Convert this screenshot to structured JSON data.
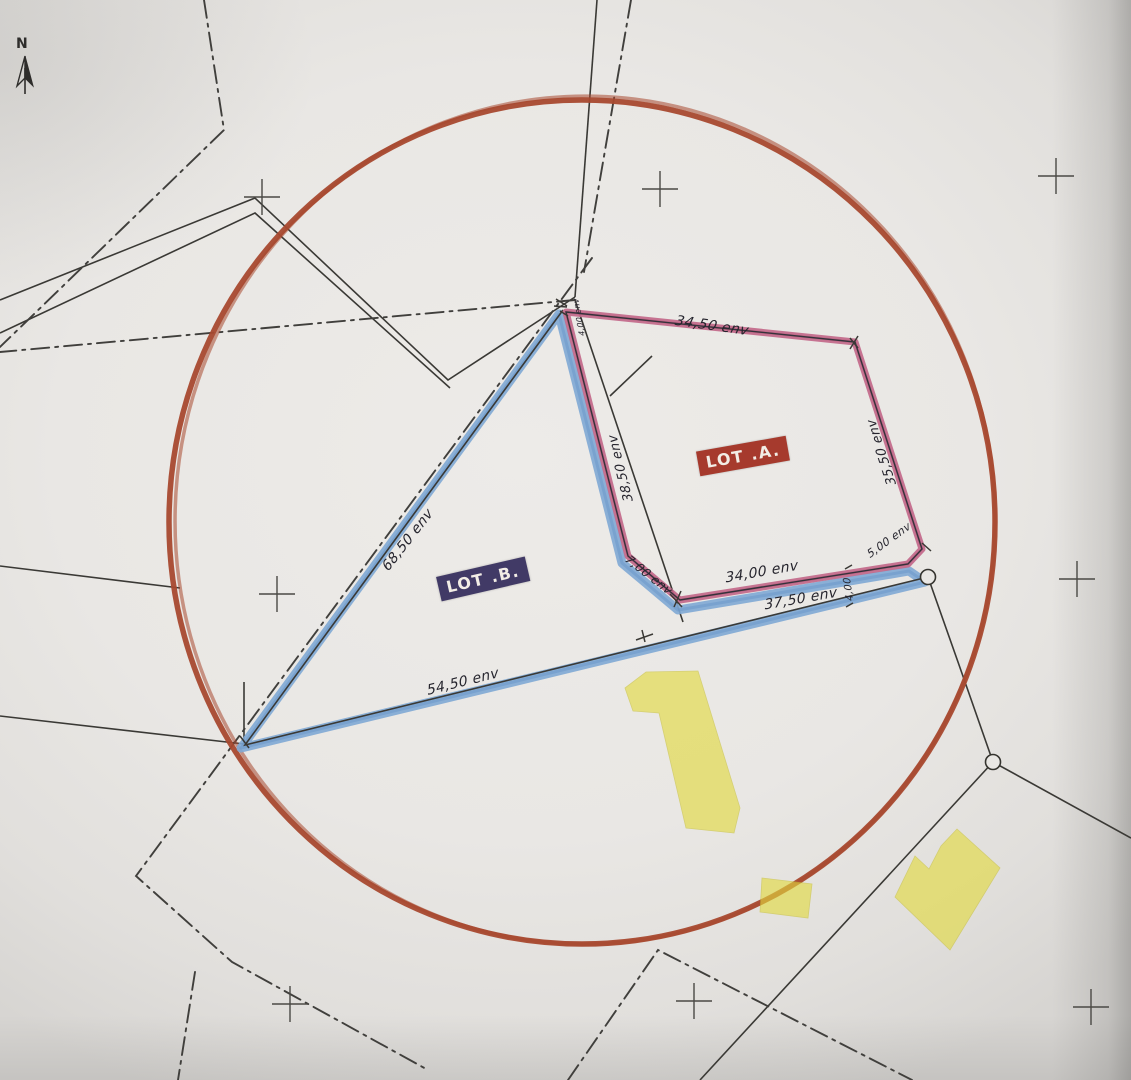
{
  "north_arrow": {
    "label": "N"
  },
  "colors": {
    "circle": "#a8492f",
    "lot_a_band": "#c2688a",
    "lot_a_core": "#b25578",
    "lot_b_band": "#7fa9d4",
    "lot_b_core": "#6795c7",
    "highlight": "#e2da3e",
    "ink": "#3a3935",
    "dash": "#403f3c",
    "paper": "#e9e7e4",
    "lot_a_label_bg": "#a63a2d",
    "lot_b_label_bg": "#413a66"
  },
  "lot_labels": [
    {
      "id": "lot-a",
      "text": "LOT .A.",
      "x": 743,
      "y": 456,
      "rot": -10,
      "bg": "#a63a2d"
    },
    {
      "id": "lot-b",
      "text": "LOT .B.",
      "x": 483,
      "y": 579,
      "rot": -13,
      "bg": "#413a66"
    }
  ],
  "measurements": [
    {
      "text": "34,50 env",
      "x": 712,
      "y": 326,
      "rot": 8,
      "size": 14
    },
    {
      "text": "35,50 env",
      "x": 882,
      "y": 452,
      "rot": -108,
      "size": 13
    },
    {
      "text": "38,50 env",
      "x": 621,
      "y": 468,
      "rot": -104,
      "size": 13
    },
    {
      "text": "7,00 env",
      "x": 649,
      "y": 575,
      "rot": 38,
      "size": 12
    },
    {
      "text": "34,00 env",
      "x": 762,
      "y": 572,
      "rot": -10,
      "size": 14
    },
    {
      "text": "5,00 env",
      "x": 889,
      "y": 540,
      "rot": -36,
      "size": 11
    },
    {
      "text": "4,00",
      "x": 849,
      "y": 589,
      "rot": -98,
      "size": 10
    },
    {
      "text": "37,50 env",
      "x": 801,
      "y": 599,
      "rot": -10,
      "size": 14
    },
    {
      "text": "54,50 env",
      "x": 463,
      "y": 682,
      "rot": -14,
      "size": 14
    },
    {
      "text": "68,50 env",
      "x": 408,
      "y": 540,
      "rot": -52,
      "size": 14
    },
    {
      "text": "4,00 env",
      "x": 579,
      "y": 317,
      "rot": -100,
      "size": 8
    }
  ],
  "drawing": {
    "circle": {
      "cx": 582,
      "cy": 522,
      "rx": 413,
      "ry": 422
    },
    "lot_a_path": "M566,312 L855,342 L922,549 L908,564 L680,600 L628,556 Z",
    "lot_b_path": "M559,314 L241,748 L925,582 L909,571 L678,610 L622,563 Z",
    "lot_b_ink": "M563,310 L245,745 L928,577",
    "ink_paths": [
      {
        "name": "boundary-north",
        "d": "M597,0 L575,297"
      },
      {
        "name": "road-edge-upper",
        "d": "M575,297 L448,380 L255,198 L0,300"
      },
      {
        "name": "road-edge-lower",
        "d": "M0,333 L255,213 L450,388"
      },
      {
        "name": "parcel-line-inner",
        "d": "M575,300 L683,622"
      },
      {
        "name": "parcel-tick-line",
        "d": "M610,396 L652,356"
      },
      {
        "name": "boundary-right",
        "d": "M928,577 L958,662 L993,762"
      },
      {
        "name": "boundary-southeast",
        "d": "M993,762 L1131,838"
      },
      {
        "name": "boundary-south",
        "d": "M993,762 L700,1080"
      },
      {
        "name": "boundary-west",
        "d": "M0,716 L244,744"
      },
      {
        "name": "boundary-stub",
        "d": "M244,682 L244,744"
      },
      {
        "name": "boundary-west-faint",
        "d": "M0,566 L180,588"
      }
    ],
    "dash_paths": [
      {
        "name": "axis-north",
        "d": "M204,0 L224,130 L0,347"
      },
      {
        "name": "axis-north-upper",
        "d": "M631,0 L584,272"
      },
      {
        "name": "axis-road-west",
        "d": "M575,300 L0,352"
      },
      {
        "name": "axis-diagonal",
        "d": "M592,258 L136,876 L232,962 L428,1070"
      },
      {
        "name": "axis-branch",
        "d": "M195,972 L178,1080"
      },
      {
        "name": "axis-southeast",
        "d": "M568,1080 L658,950 L912,1080"
      }
    ],
    "yellow_shapes": [
      {
        "name": "highlighted-building-1",
        "points": "625,688 646,672 698,671 740,808 734,833 686,828 659,713 633,711"
      },
      {
        "name": "highlighted-building-2",
        "points": "762,878 812,884 808,918 760,912"
      },
      {
        "name": "highlighted-building-3",
        "points": "957,829 1000,868 950,950 895,897 915,856 929,869 941,846"
      }
    ],
    "crosses": [
      [
        262,
        197
      ],
      [
        660,
        189
      ],
      [
        1056,
        176
      ],
      [
        277,
        594
      ],
      [
        1077,
        579
      ],
      [
        290,
        1004
      ],
      [
        694,
        1001
      ],
      [
        1091,
        1007
      ]
    ],
    "point_circles": [
      [
        928,
        577
      ],
      [
        993,
        762
      ]
    ],
    "tick_paths": [
      "M556,299 l11,7 M554,306 l13,1 M560,311 l8,5",
      "M670,594 l12,13 M681,591 l-7,16",
      "M636,640 l17,-6 M642,630 l3,12",
      "M850,338 l8,10 M858,336 l-8,13",
      "M845,569 l7,-4 M853,603 l-7,4",
      "M240,736 l9,12",
      "M922,543 l9,8"
    ]
  }
}
